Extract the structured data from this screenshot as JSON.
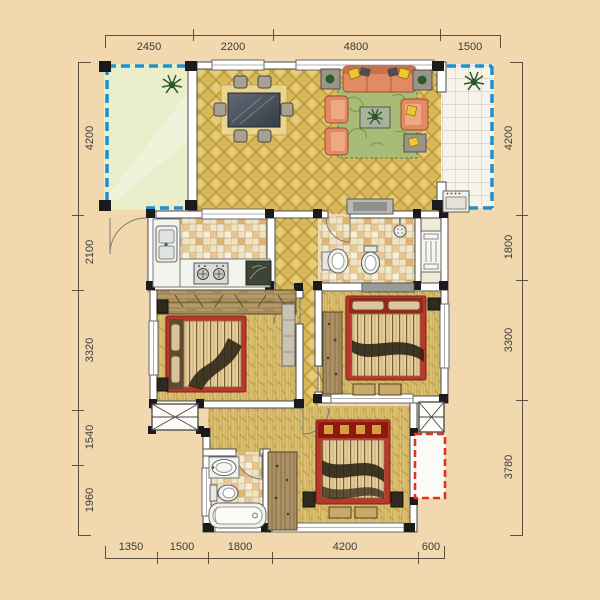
{
  "plan": {
    "type": "residential floor plan",
    "units": "mm"
  },
  "dimensions": {
    "top": [
      "2450",
      "2200",
      "4800",
      "1500"
    ],
    "left": [
      "4200",
      "2100",
      "3320",
      "1540",
      "1960"
    ],
    "right": [
      "4200",
      "1800",
      "3300",
      "3780"
    ],
    "bottom": [
      "1350",
      "1500",
      "1800",
      "4200",
      "600"
    ]
  },
  "colors": {
    "background": "#f2d8ae",
    "balcony_dashed_outline": "#1f8fd0",
    "ac_platform_dashed_outline": "#e03225",
    "gold_tile_floor": "#d8b85c",
    "entry_balcony_floor": "#eaeecb",
    "wall_dark": "#1b1b1b",
    "bed_frame_red": "#b8392b",
    "sofa_salmon": "#e28a63",
    "rug_green": "#a9bc77",
    "dimension_text": "#3b3b3b"
  },
  "icons": [
    "plant-icon",
    "dining-table-icon",
    "chair-icon",
    "sofa-icon",
    "armchair-icon",
    "coffee-table-icon",
    "tv-cabinet-icon",
    "kitchen-sink-icon",
    "stove-icon",
    "refrigerator-icon",
    "washing-machine-icon",
    "basin-icon",
    "toilet-icon",
    "shower-icon",
    "bathtub-icon",
    "bed-icon",
    "wardrobe-icon",
    "nightstand-icon",
    "bench-icon",
    "duct-shaft-icon",
    "radiator-icon",
    "door-swing-icon",
    "ac-platform-icon",
    "window-icon"
  ]
}
